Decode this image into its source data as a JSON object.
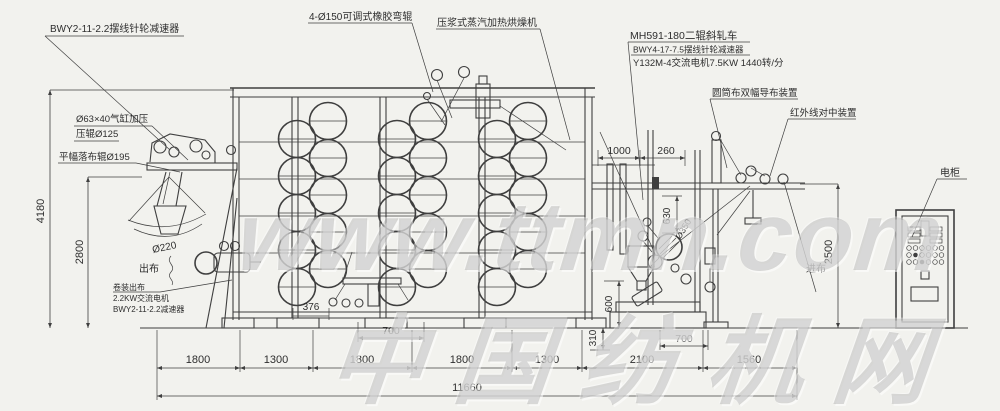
{
  "labels": {
    "reducer_tl": "BWY2-11-2.2摆线针轮减速器",
    "bend_roller": "4-Ø150可调式橡胶弯辊",
    "dryer": "压浆式蒸汽加热烘燥机",
    "padder_model": "MH591-180二辊斜轧车",
    "padder_reducer": "BWY4-17-7.5摆线针轮减速器",
    "padder_motor": "Y132M-4交流电机7.5KW 1440转/分",
    "guide_device": "圆筒布双幅导布装置",
    "infrared_device": "红外线对中装置",
    "cabinet": "电柜",
    "air_cylinder": "Ø63×40气缸加压",
    "press_roll": "压辊Ø125",
    "flat_drop_roll": "平幅落布辊Ø195",
    "cloth_out": "出布",
    "cloth_in": "进布",
    "roll_220": "Ø220",
    "roll_350": "Ø350",
    "roll_out_line1": "卷装出布",
    "roll_out_line2": "2.2KW交流电机",
    "roll_out_line3": "BWY2-11-2.2减速器"
  },
  "dims": {
    "total_height": "4180",
    "height_2800": "2800",
    "height_2500": "2500",
    "width_1000": "1000",
    "width_260": "260",
    "height_630": "630",
    "height_600": "600",
    "height_310": "310",
    "width_376": "376",
    "width_700_left": "700",
    "width_700_right": "700",
    "bottom_row": [
      "1800",
      "1300",
      "1800",
      "1800",
      "1300",
      "2100",
      "1560"
    ],
    "total_length": "11660"
  },
  "watermark": {
    "line1": "www.ttmn.com",
    "line2": "中国纺机网"
  },
  "colors": {
    "paper": "#f2f2ee",
    "ink": "#3f3f3f",
    "watermark": "#969696"
  }
}
